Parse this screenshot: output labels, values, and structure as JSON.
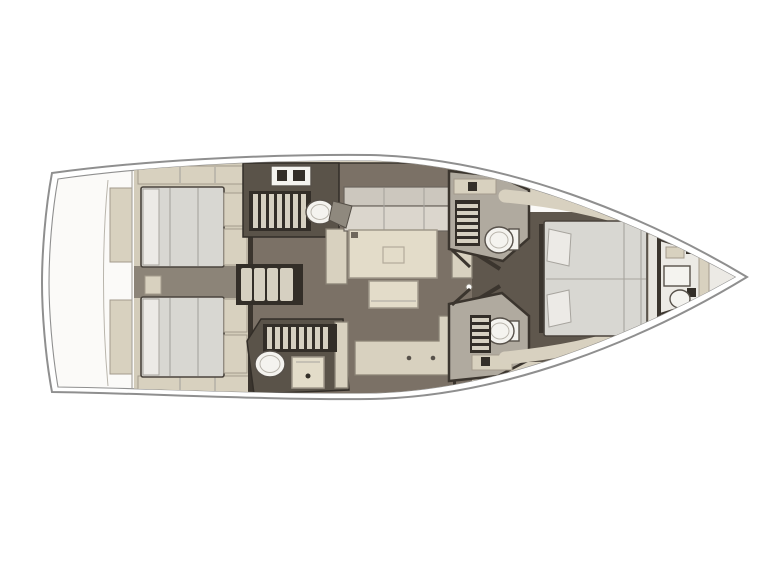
{
  "diagram": {
    "type": "sailboat-interior-floor-plan",
    "orientation": "top-view-bow-right",
    "colors": {
      "background": "#ffffff",
      "hull_line": "#8f8f8f",
      "deck_white": "#fbfaf8",
      "side_deck": "#d8d1c0",
      "floor": "#7b7166",
      "floor_dark": "#5f574d",
      "wall": "#3b352e",
      "cabin_base": "#d3ccba",
      "cabinetry": "#d8d1bf",
      "galley_dark": "#5a5349",
      "stripe_dark": "#332e28",
      "stripe_light": "#d6d0c1",
      "mattress": "#d8d7d2",
      "mattress_line": "#a7a49e",
      "pillow": "#eceae6",
      "cushion_back": "#ccc7be",
      "cushion_seat": "#dbd6cd",
      "cushion_dark": "#8f897e",
      "table": "#e3dcc9",
      "fixture_white": "#f4f3ef",
      "fixture_line": "#57514a",
      "head_floor": "#b0aa9f",
      "bow_tint": "#eceae5",
      "between_beds": "#8c8478"
    },
    "areas": {
      "stern_platform": {
        "fixtures": [
          "transom-locker-port",
          "transom-locker-starboard"
        ]
      },
      "aft_cabin_port": {
        "fixtures": [
          "double-bed",
          "pillows",
          "foot-lockers",
          "wardrobe-shelf"
        ]
      },
      "aft_cabin_starboard": {
        "fixtures": [
          "double-bed",
          "pillows",
          "foot-lockers",
          "wardrobe-shelf"
        ]
      },
      "companionway": {
        "fixtures": [
          "steps"
        ],
        "step_count": 4
      },
      "galley_port": {
        "fixtures": [
          "stove",
          "drainer-grate",
          "sink",
          "door-swing"
        ]
      },
      "galley_starboard": {
        "fixtures": [
          "drainer-grate",
          "sink",
          "oven"
        ]
      },
      "saloon": {
        "fixtures": [
          "u-settee",
          "dining-table",
          "movable-bench",
          "side-seat-port",
          "side-seat-starboard",
          "sideboard",
          "door-knob"
        ]
      },
      "head_forward_port": {
        "fixtures": [
          "washbasin",
          "shower-grate",
          "toilet"
        ]
      },
      "head_forward_starboard": {
        "fixtures": [
          "toilet",
          "shower-grate",
          "washbasin"
        ]
      },
      "owner_cabin_forward": {
        "fixtures": [
          "island-double-bed",
          "pillows",
          "headboard",
          "side-shelves",
          "bulkhead"
        ]
      },
      "bow_compartment": {
        "fixtures": [
          "seat",
          "toilet",
          "locker",
          "shelf"
        ]
      }
    }
  }
}
